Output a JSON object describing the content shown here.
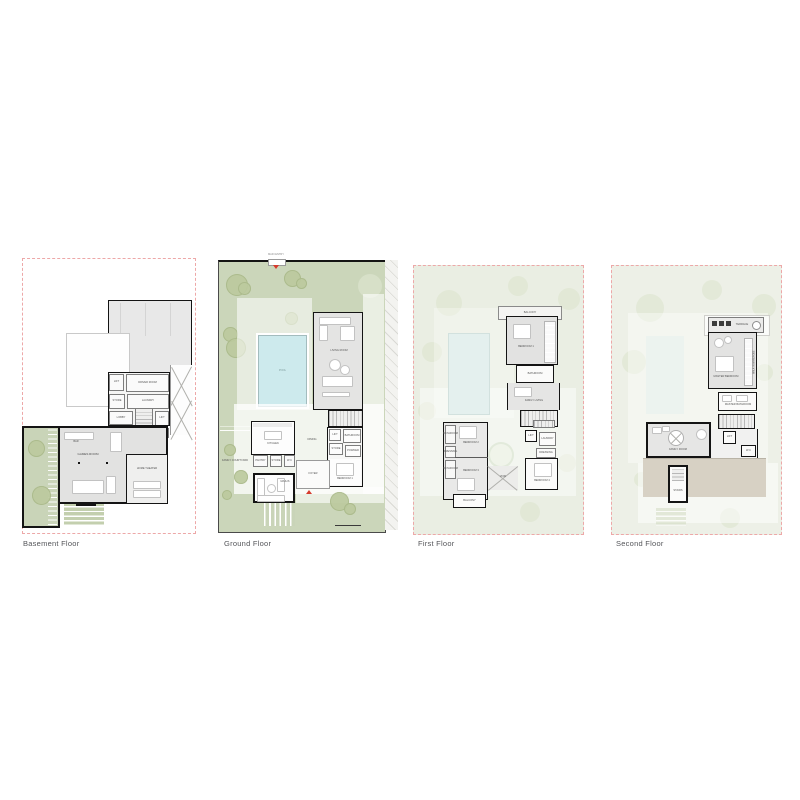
{
  "page": {
    "background": "#ffffff"
  },
  "colors": {
    "boundary_dashed": "#eda8a8",
    "garden_green": "#cbd6ba",
    "garden_faded": "#eaeee3",
    "tree_green": "#bcca9e",
    "pool_blue": "#cdeaed",
    "wall_black": "#141414",
    "floor_gray": "#e4e4e3",
    "terrace_tan": "#d7d1c4",
    "entry_marker_red": "#d63a2c",
    "caption_gray": "#55565a"
  },
  "floors": [
    {
      "caption": "Basement Floor",
      "labels": {
        "lift": "LIFT",
        "driver": "DRIVER ROOM",
        "store": "STORE",
        "laundry": "LAUNDRY",
        "lobby": "LOBBY",
        "lift2": "LIFT",
        "store2": "STORE",
        "bar": "BAR",
        "games": "GAMES ROOM",
        "theater": "HOME THEATER"
      }
    },
    {
      "caption": "Ground Floor",
      "labels": {
        "entry": "MAIN ENTRY",
        "pool": "POOL",
        "living": "LIVING ROOM",
        "dining": "DINING",
        "kitchen": "KITCHEN",
        "pantry": "PANTRY",
        "store": "STORE",
        "wc": "W.C",
        "majlis": "MAJLIS",
        "courtyard": "FAMILY COURTYARD",
        "foyer": "FOYER",
        "lift": "LIFT",
        "bath": "BATHROOM",
        "powder": "POWDER",
        "bedroom1": "BEDROOM 1"
      }
    },
    {
      "caption": "First Floor",
      "labels": {
        "balcony_top": "BALCONY",
        "bedroom1": "BEDROOM 1",
        "wardrobe": "WARDROBE",
        "bathroom": "BATHROOM",
        "family": "FAMILY LIVING",
        "bath2": "BATHROOM",
        "dressing": "DRESSING",
        "bath3": "BATHROOM",
        "bedroom2": "BEDROOM 2",
        "bedroom3": "BEDROOM 3",
        "balcony": "BALCONY",
        "lift": "LIFT",
        "laundry": "LAUNDRY",
        "wardrobe2": "DRESSING",
        "bedroom4": "BEDROOM 4",
        "void": "VOID"
      }
    },
    {
      "caption": "Second Floor",
      "labels": {
        "terrace_top": "TERRACE",
        "master": "MASTER BEDROOM",
        "wardrobe": "WALK-IN WARDROBE",
        "bathroom": "MASTER BATHROOM",
        "family": "FAMILY ROOM",
        "lift": "LIFT",
        "wc": "W.C",
        "stairs": "STAIRS"
      }
    }
  ]
}
